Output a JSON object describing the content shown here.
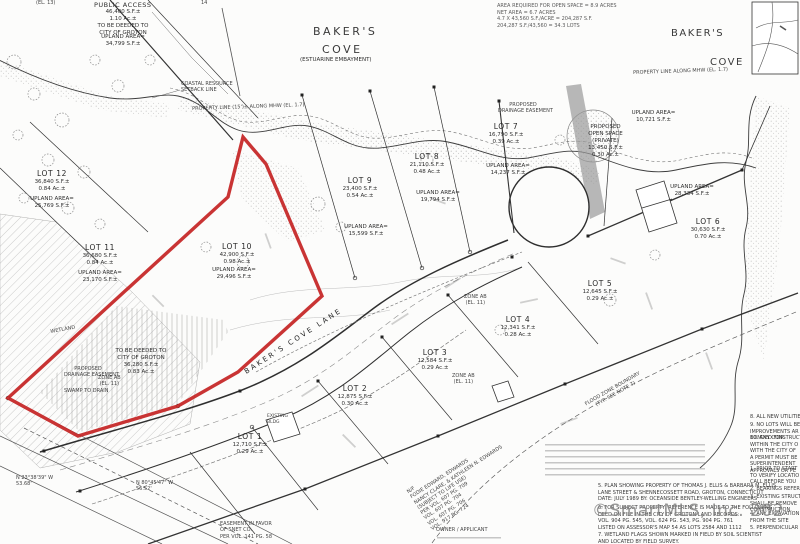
{
  "watermark": {
    "text": "©SmartMLS, Inc.  202"
  },
  "colors": {
    "red_outline": "#c42323",
    "ink": "#2e2e2e"
  },
  "titles": {
    "cove_left": [
      "BAKER'S",
      "COVE",
      "(ESTUARINE EMBAYMENT)"
    ],
    "cove_right": [
      "BAKER'S",
      "COVE"
    ]
  },
  "public_access": {
    "title": "PUBLIC ACCESS",
    "lines": [
      "46,400 S.F.±",
      "1.10 Ac.±",
      "TO BE DEEDED TO",
      "CITY OF GROTON"
    ],
    "upland": [
      "UPLAND AREA=",
      "34,799 S.F.±"
    ]
  },
  "top_note": {
    "lines": [
      "AREA REQUIRED FOR OPEN SPACE = 8.9 ACRES",
      "NET AREA = 6.7 ACRES",
      "4.7 X 43,560 S.F./ACRE = 204,287 S.F.",
      "204,287 S.F./43,560 = 34.3 LOTS"
    ]
  },
  "lots": [
    {
      "name": "LOT 1",
      "sf": "12,710 S.F.±",
      "ac": "0.29 Ac.±"
    },
    {
      "name": "LOT 2",
      "sf": "12,875 S.F.±",
      "ac": "0.30 Ac.±"
    },
    {
      "name": "LOT 3",
      "sf": "12,584 S.F.±",
      "ac": "0.29 Ac.±"
    },
    {
      "name": "LOT 4",
      "sf": "12,341 S.F.±",
      "ac": "0.28 Ac.±"
    },
    {
      "name": "LOT 5",
      "sf": "12,645 S.F.±",
      "ac": "0.29 Ac.±"
    },
    {
      "name": "LOT 6",
      "sf": "30,630 S.F.±",
      "ac": "0.70 Ac.±",
      "upland_label": "UPLAND AREA=",
      "upland_sf": "28,334 S.F.±"
    },
    {
      "name": "LOT 7",
      "sf": "16,790 S.F.±",
      "ac": "0.39 Ac.±",
      "upland_label": "UPLAND AREA=",
      "upland_sf": "14,237 S.F.±"
    },
    {
      "name": "LOT 8",
      "sf": "21,110 S.F.±",
      "ac": "0.48 Ac.±",
      "upland_label": "UPLAND AREA=",
      "upland_sf": "19,794 S.F.±"
    },
    {
      "name": "LOT 9",
      "sf": "23,400 S.F.±",
      "ac": "0.54 Ac.±",
      "upland_label": "UPLAND AREA=",
      "upland_sf": "15,599 S.F.±"
    },
    {
      "name": "LOT 10",
      "sf": "42,900 S.F.±",
      "ac": "0.98 Ac.±",
      "upland_label": "UPLAND AREA=",
      "upland_sf": "29,496 S.F.±"
    },
    {
      "name": "LOT 11",
      "sf": "36,680 S.F.±",
      "ac": "0.84 Ac.±",
      "upland_label": "UPLAND AREA=",
      "upland_sf": "23,170 S.F.±"
    },
    {
      "name": "LOT 12",
      "sf": "36,840 S.F.±",
      "ac": "0.84 Ac.±",
      "upland_label": "UPLAND AREA=",
      "upland_sf": "25,769 S.F.±"
    }
  ],
  "open_space": {
    "lines": [
      "PROPOSED",
      "OPEN SPACE",
      "(PRIVATE)",
      "13,450 S.F.±",
      "0.30 Ac.±"
    ],
    "upland_label": "UPLAND AREA=",
    "upland_sf": "10,721 S.F.±"
  },
  "deeded": {
    "lines": [
      "TO BE DEEDED TO",
      "CITY OF GROTON",
      "36,280 S.F.±",
      "0.83 Ac.±"
    ]
  },
  "labels": {
    "el13": [
      "(EL. 13)"
    ],
    "fourteen": [
      "14"
    ],
    "coastal": [
      "COASTAL RESOURCE",
      "SETBACK LINE"
    ],
    "mhw_left": [
      "PROPERTY LINE (15')± ALONG MHW (EL. 1.7)"
    ],
    "mhw_right": [
      "PROPERTY LINE ALONG MHW (EL. 1.7)"
    ],
    "drainage": [
      "PROPOSED",
      "DRAINAGE EASEMENT"
    ],
    "zone_ab": [
      "ZONE AB",
      "(EL. 11)"
    ],
    "flood": [
      "FLOOD ZONE BOUNDARY",
      "(TYP. SEE NOTE 7)"
    ],
    "wetland": [
      "WETLAND"
    ],
    "swamp": [
      "SWAMP TO DRAIN"
    ],
    "road": [
      "BAKER'S COVE LANE"
    ],
    "bearing1": [
      "N 23°38'39\" W",
      "53.68'"
    ],
    "bearing2": [
      "N 80°45'47\" W",
      "56.52'"
    ],
    "snet": [
      "EASEMENT IN FAVOR",
      "OF SNET CO.",
      "PER VOL. 141 PG. 58"
    ],
    "owners": [
      "N/F",
      "FODIE EDWARD, EDWARDS",
      "NANCY CLARE, & KATHLEEN N. EDWARDS",
      "(SUBJECT TO LIFE USE)",
      "PER VOL. 607 PG. 709",
      "VOL. 607 PG. 704",
      "VOL. 607 PG. 706",
      "VOL. 917 PG. 724"
    ],
    "owner_applicant": [
      "OWNER / APPLICANT"
    ],
    "existing_bldg": [
      "EXISTING",
      "BLDG"
    ]
  },
  "notes_right": [
    [
      "8. ALL NEW UTILITIE"
    ],
    [
      "9. NO LOTS WILL BE",
      "IMPROVEMENTS AR",
      "BONDED FOR."
    ],
    [
      "10. ANY CONSTRUCTIO",
      "WITHIN THE CITY O",
      "WITH THE CITY OF",
      "A PERMIT MUST BE",
      "SUPERINTENDENT",
      "APPROVALS OR PE"
    ],
    [
      "1. PRIOR TO START",
      "TO VERIFY LOCATIO",
      "CALL BEFORE YOU"
    ],
    [
      "2. BEARINGS REFER"
    ],
    [
      "3. EXISTING STRUCT",
      "SHALL BE REMOVE",
      "CONSTRUCTION."
    ],
    [
      "4. ANY EXCAVATION",
      "FROM THE SITE"
    ],
    [
      "5. PERPENDICULAR"
    ]
  ],
  "notes_bottom": [
    [
      "5. PLAN SHOWING PROPERTY OF THOMAS J. ELLIS & BARBARA M. ELLIS",
      "LANE STREET & SHENNECOSSETT ROAD, GROTON, CONNECTICUT",
      "DATE: JULY 1989 BY: OCEANSIDE BENTLEY-WELLING ENGINEERS"
    ],
    [
      "6. FOR SUBJECT PROPERTY, REFERENCE IS MADE TO THE FOLLOWING",
      "DEED ON FILE IN THE CITY OF GROTON LAND RECORDS:",
      "VOL. 904 PG. 545, VOL. 624 PG. 543, PG. 904 PG. 761",
      "LISTED ON ASSESSOR'S MAP 54 AS LOTS 2584 AND 1112"
    ],
    [
      "7. WETLAND FLAGS SHOWN MARKED IN FIELD BY SOIL SCIENTIST",
      "AND LOCATED BY FIELD SURVEY."
    ]
  ]
}
